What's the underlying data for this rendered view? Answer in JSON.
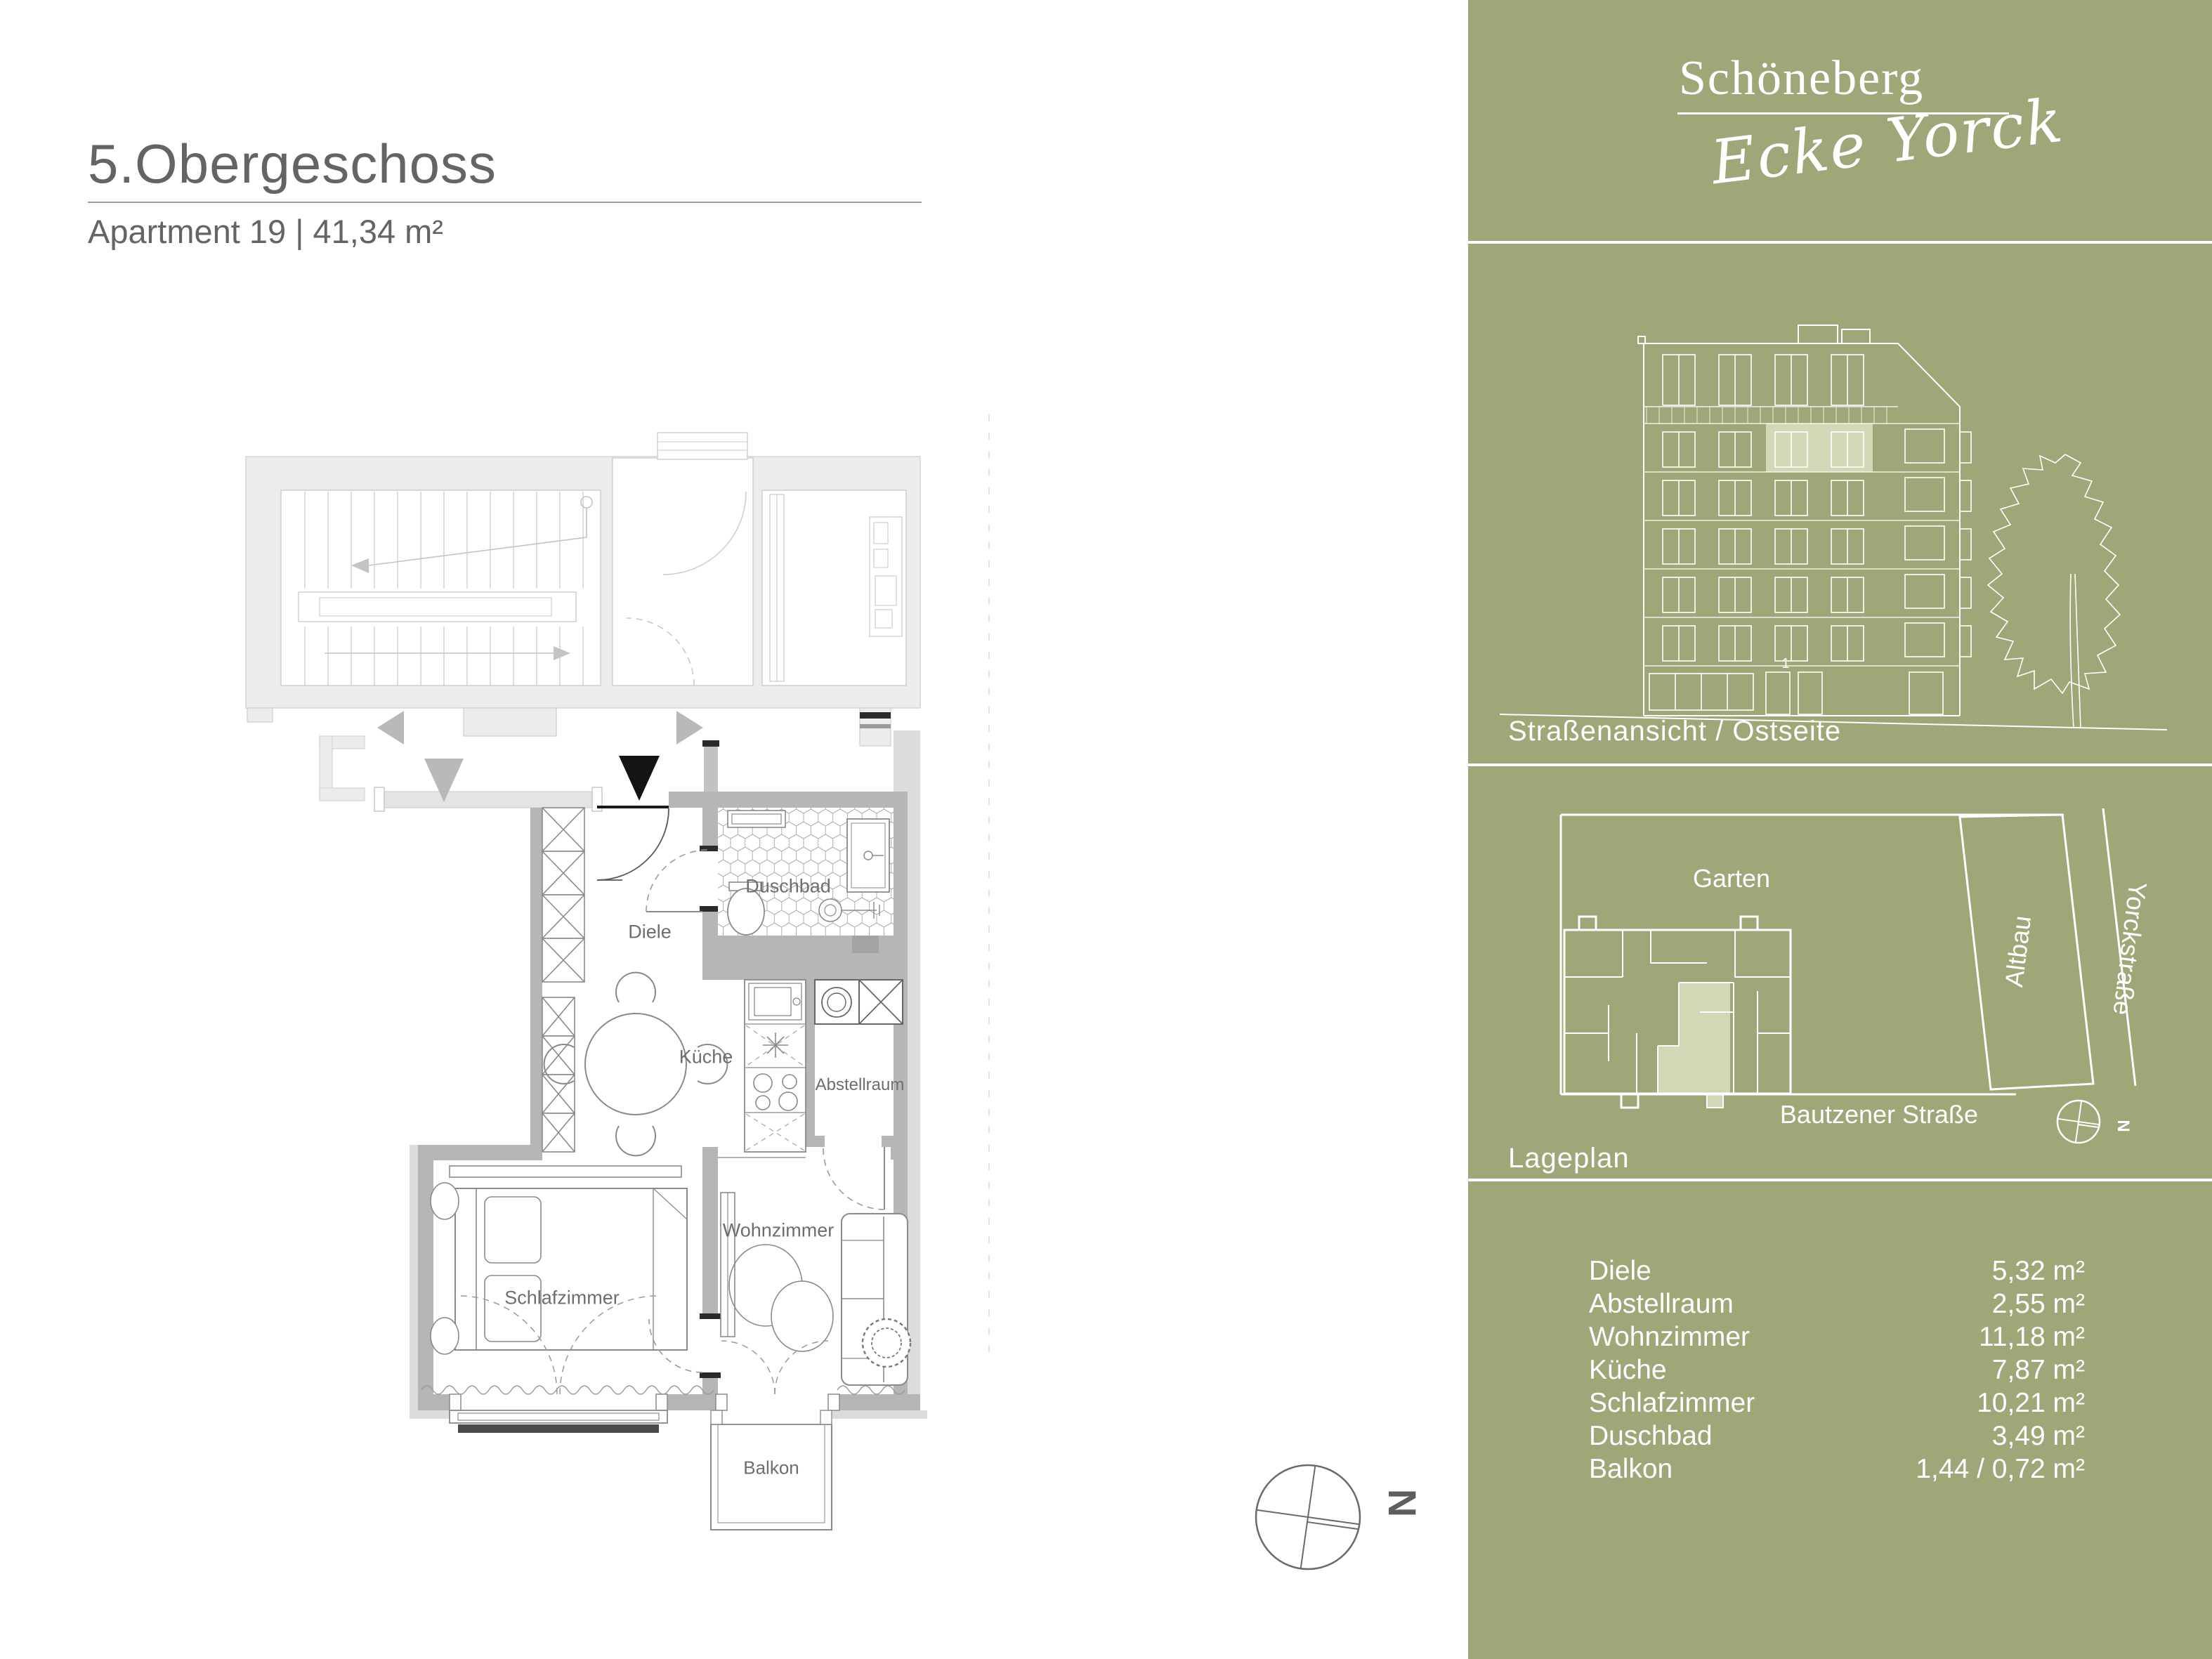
{
  "header": {
    "title": "5.Obergeschoss",
    "subtitle": "Apartment 19 | 41,34 m²"
  },
  "plan": {
    "labels": {
      "diele": "Diele",
      "duschbad": "Duschbad",
      "kueche": "Küche",
      "abstellraum": "Abstellraum",
      "schlafzimmer": "Schlafzimmer",
      "wohnzimmer": "Wohnzimmer",
      "balkon": "Balkon"
    },
    "north_letter": "N"
  },
  "sidebar": {
    "colors": {
      "green": "#9da777",
      "highlight": "#d3d7b5"
    },
    "logo": {
      "line1": "Schöneberg",
      "line2": "Ecke Yorck"
    },
    "elevation": {
      "caption": "Straßenansicht / Ostseite",
      "unit_number": "1"
    },
    "siteplan": {
      "caption": "Lageplan",
      "garten": "Garten",
      "altbau": "Altbau",
      "yorckstrasse": "Yorckstraße",
      "bautzener": "Bautzener Straße",
      "north_letter": "N"
    },
    "areas": {
      "rows": [
        {
          "label": "Diele",
          "value": "5,32 m²"
        },
        {
          "label": "Abstellraum",
          "value": "2,55 m²"
        },
        {
          "label": "Wohnzimmer",
          "value": "11,18 m²"
        },
        {
          "label": "Küche",
          "value": "7,87 m²"
        },
        {
          "label": "Schlafzimmer",
          "value": "10,21 m²"
        },
        {
          "label": "Duschbad",
          "value": "3,49 m²"
        },
        {
          "label": "Balkon",
          "value": "1,44 / 0,72 m²"
        }
      ]
    }
  }
}
